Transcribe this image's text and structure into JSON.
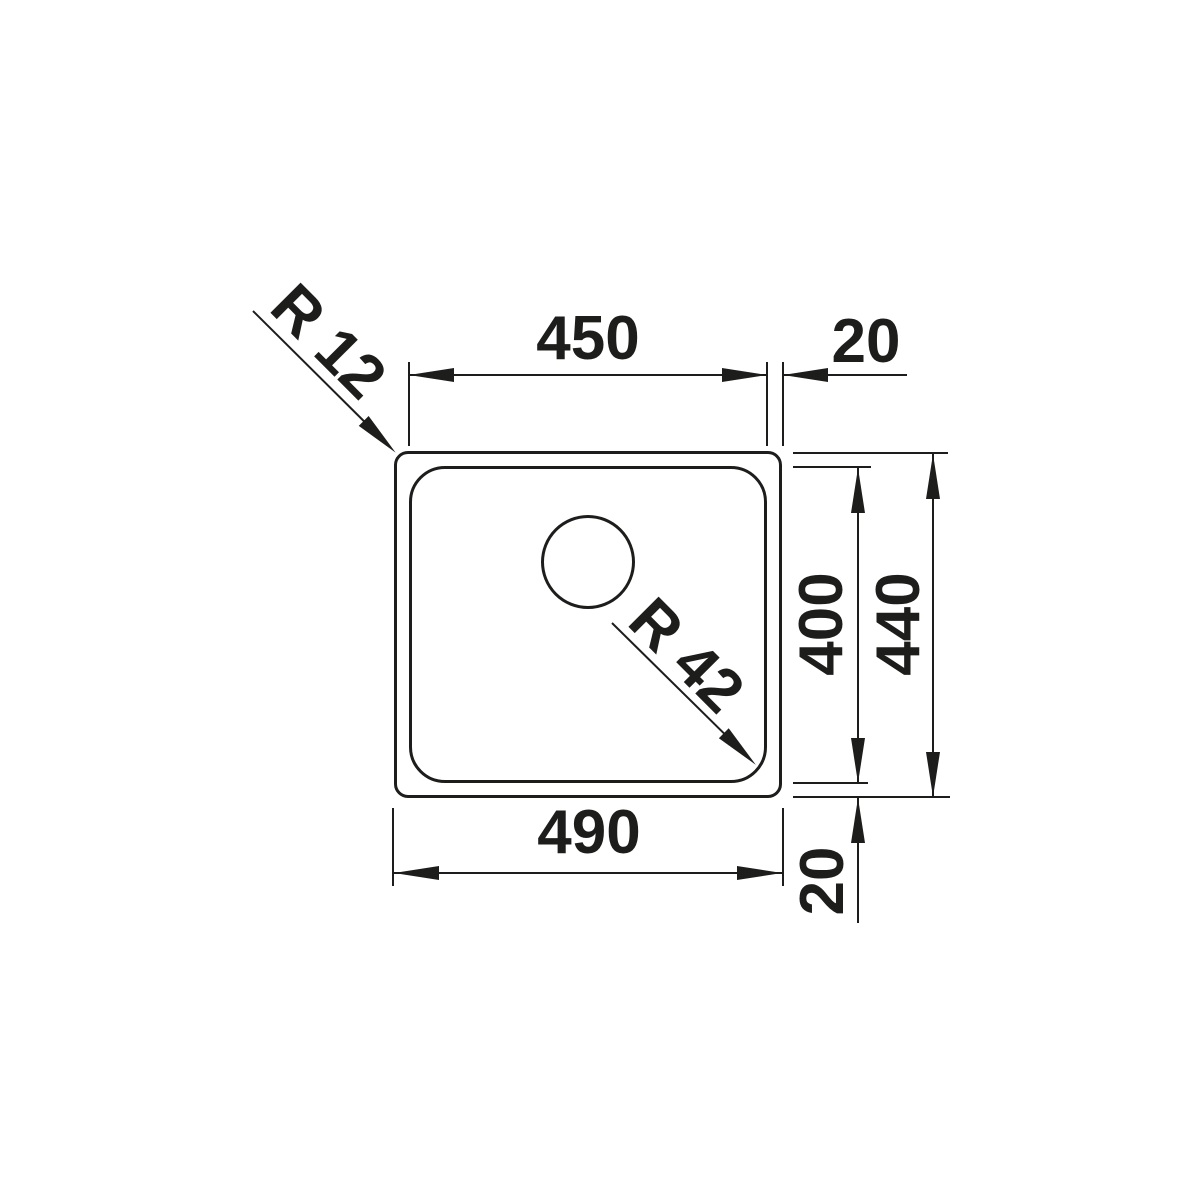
{
  "drawing": {
    "line_color": "#1d1d1b",
    "background_color": "#ffffff"
  },
  "labels": {
    "inner_width": "450",
    "rim_right": "20",
    "outer_width": "490",
    "inner_depth": "400",
    "outer_depth": "440",
    "rim_bottom": "20",
    "outer_corner_radius": "R 12",
    "bowl_corner_radius": "R 42"
  }
}
